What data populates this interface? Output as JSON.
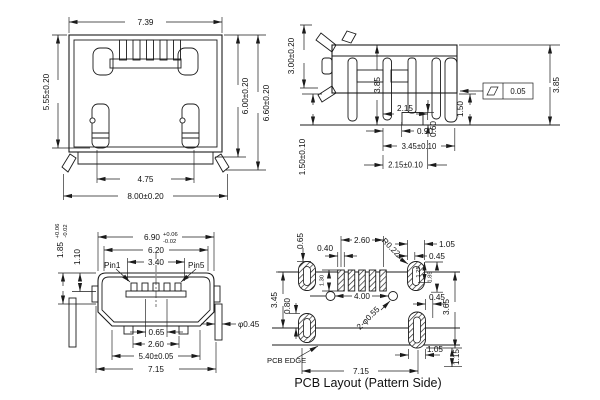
{
  "front_view": {
    "width_top": "7.39",
    "height_left": "5.55±0.20",
    "height_inner_right": "6.00±0.20",
    "height_outer_right": "6.60±0.20",
    "width_slots": "4.75",
    "width_bottom": "8.00±0.20"
  },
  "side_view": {
    "height_tab": "3.00±0.20",
    "height_body": "3.85",
    "width_pin_gap": "2.15",
    "width_lead": "0.90",
    "lead_thickness": "0.60",
    "width_mid": "3.45±0.10",
    "width_lower": "2.15±0.10",
    "height_foot": "1.50±0.10",
    "flatness": "0.05",
    "height_lead": "1.50",
    "height_right": "3.85"
  },
  "mating_view": {
    "width_shell": "6.90",
    "width_shell_tol_plus": "+0.06",
    "width_shell_tol_minus": "-0.02",
    "width_inner": "6.20",
    "width_pins": "3.40",
    "pin1_label": "Pin1",
    "pin5_label": "Pin5",
    "height_opening": "1.85",
    "height_opening_tol_plus": "+0.06",
    "height_opening_tol_minus": "-0.02",
    "height_tongue": "1.10",
    "pin_pitch": "0.65",
    "width_bumps": "2.60",
    "width_feet": "5.40±0.05",
    "width_overall": "7.15",
    "leg_width": "φ0.45"
  },
  "pcb_view": {
    "pad_offset": "0.65",
    "pad_span": "2.60",
    "pad_width": "0.40",
    "corner_radius": "R0.22",
    "shield_pad_width": "1.05",
    "slot_width": "0.45",
    "shield_pad_inner": "1.25",
    "shield_pad_height": "1.85",
    "signal_pad_height": "1.30",
    "height_left": "3.45",
    "height_lower_left": "0.80",
    "hole_span": "4.00",
    "holes": "2-φ0.55",
    "gap_right": "0.45",
    "height_right": "3.65",
    "pad_width_bottom": "1.05",
    "edge_offset": "1.15",
    "width_bottom": "7.15",
    "edge_label": "PCB EDGE",
    "caption": "PCB Layout (Pattern Side)"
  }
}
